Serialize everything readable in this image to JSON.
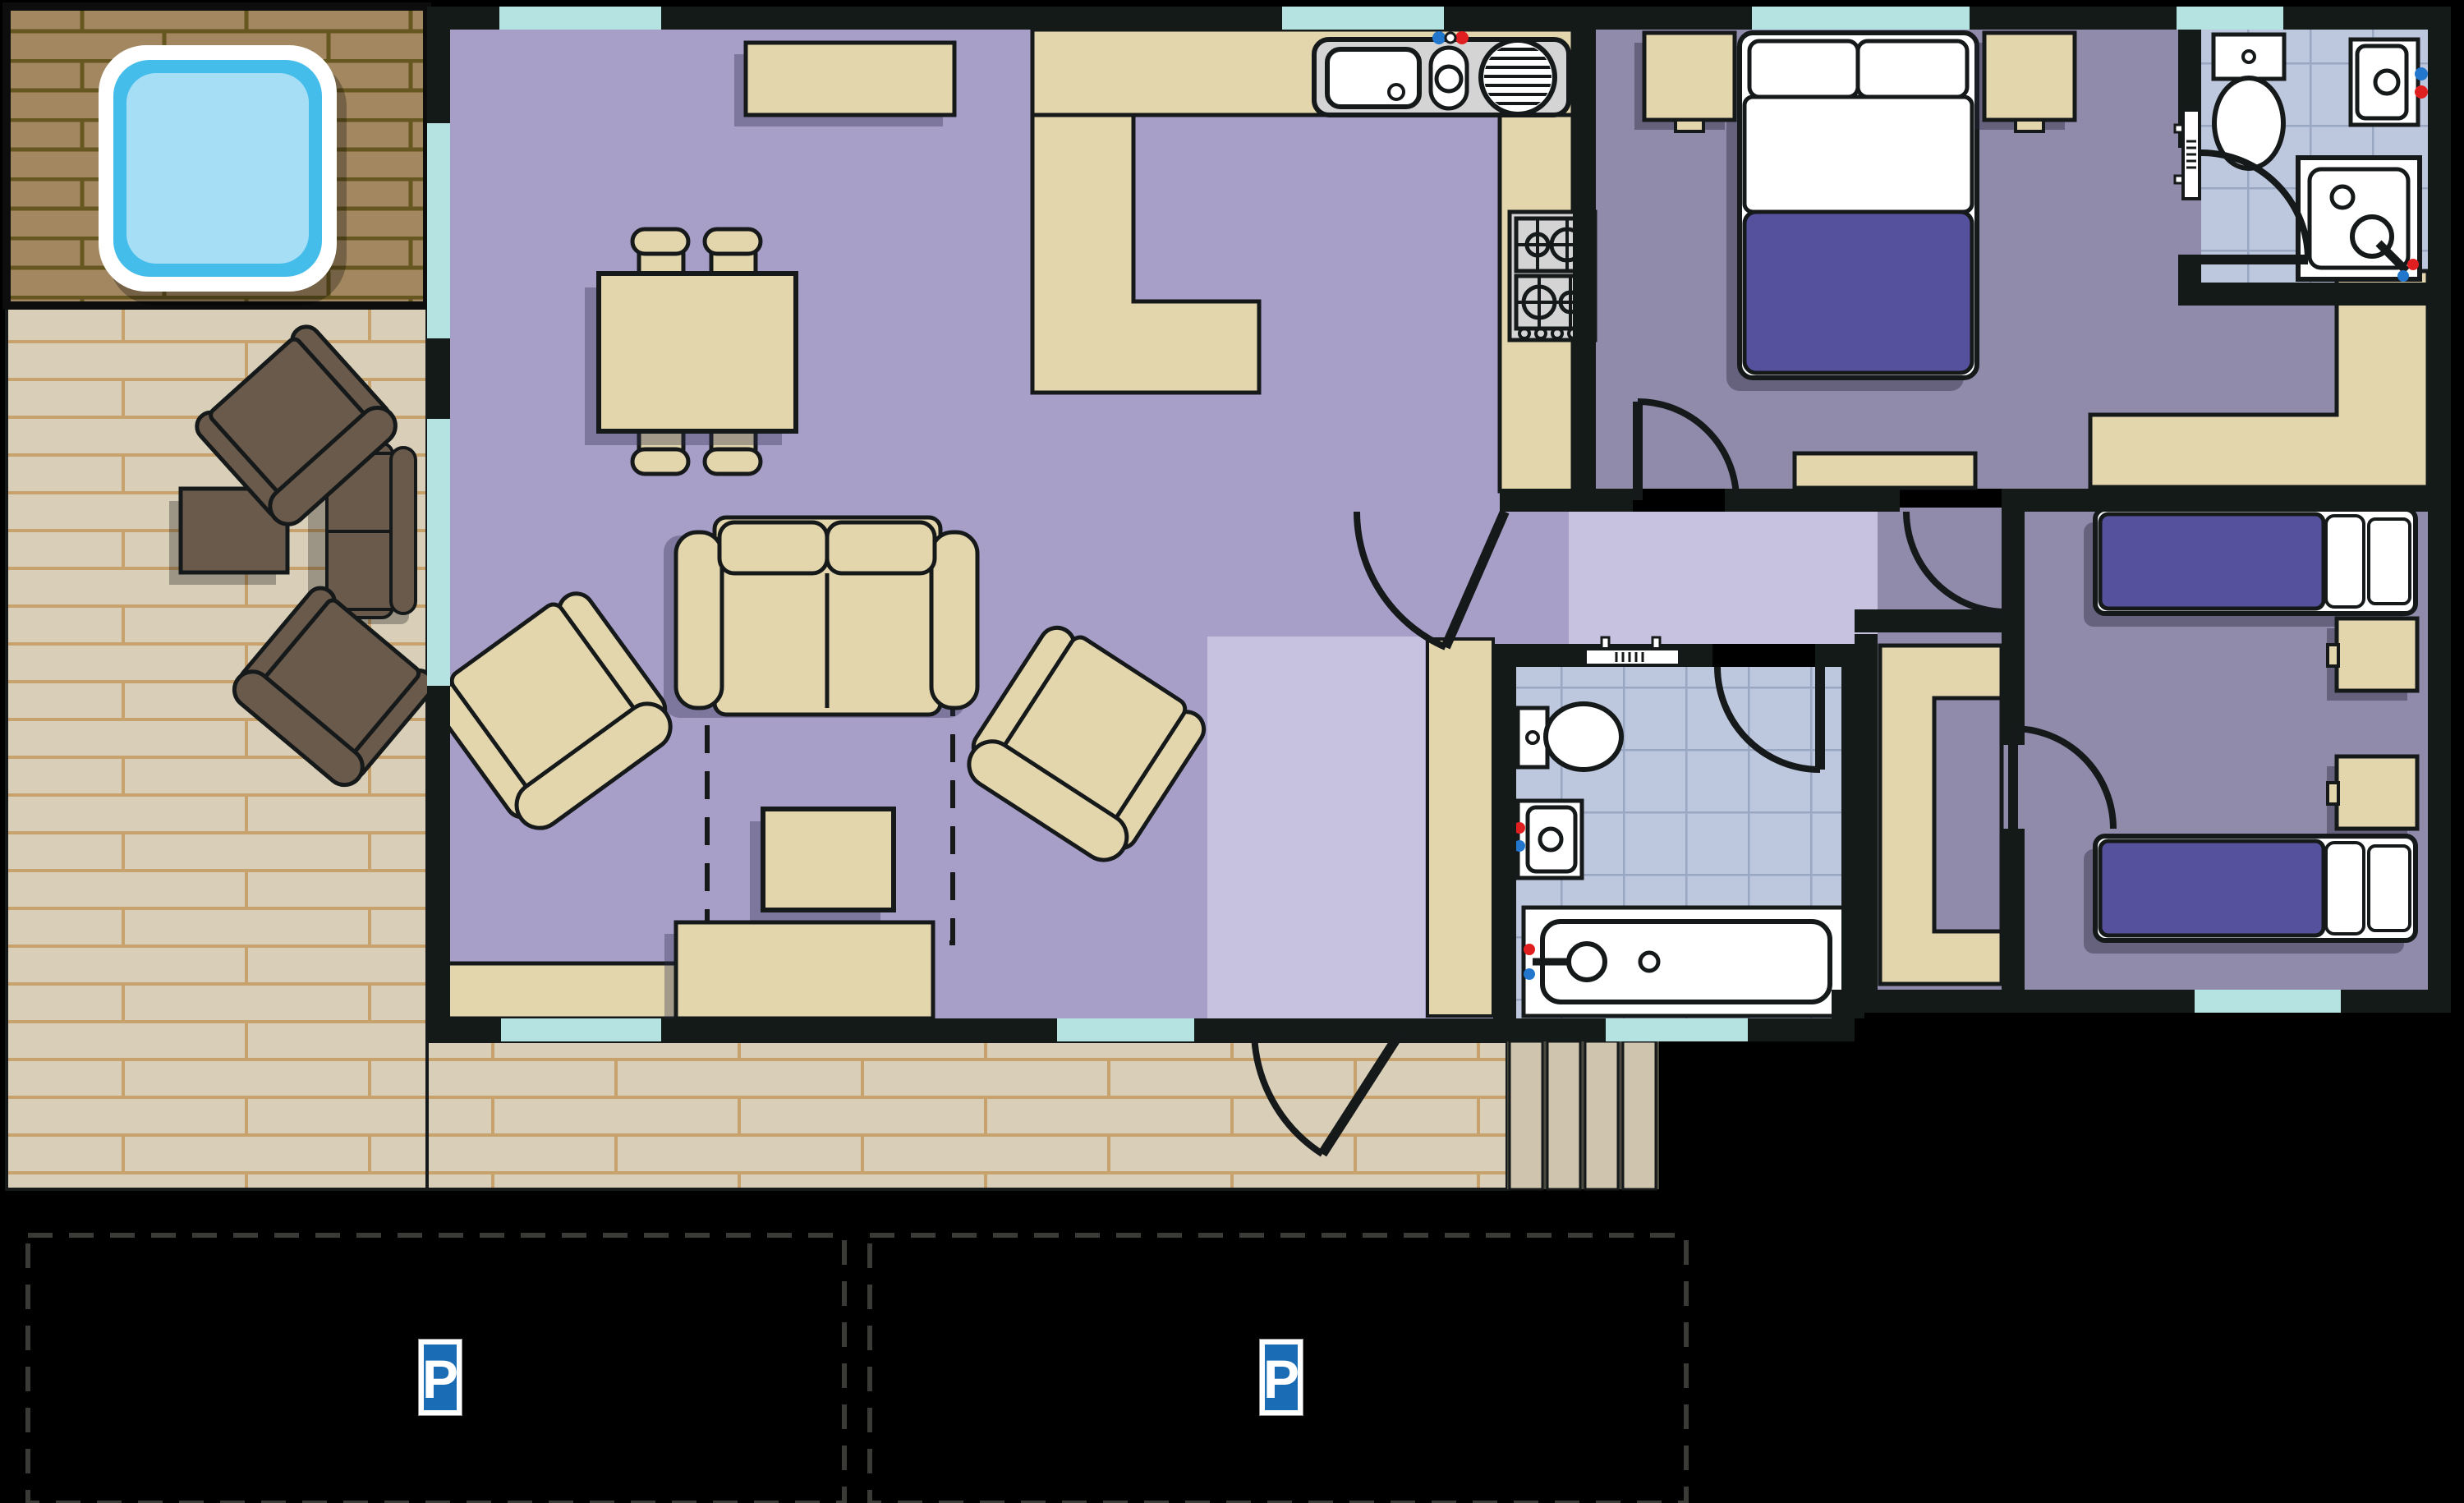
{
  "plan": {
    "type": "holiday-lodge-floor-plan",
    "rooms": [
      "hot-tub-patio",
      "deck",
      "living-room",
      "kitchen",
      "entrance-hall",
      "hallway",
      "bathroom",
      "master-bedroom",
      "ensuite-bathroom",
      "twin-bedroom",
      "parking"
    ]
  },
  "palette": {
    "outside": "#000000",
    "wall": "#141a18",
    "floor_living": "#a89fc9",
    "floor_bedroom": "#908aab",
    "floor_hall": "#c7c2df",
    "floor_tile": "#bdc7dd",
    "tile_line": "#9aa7c2",
    "window": "#b4e3e1",
    "cream": "#e3d6ac",
    "duvet": "#55519c",
    "deck_brick": "#d9cfb9",
    "deck_line": "#c8a26d",
    "patio_brick": "#a28760",
    "patio_line": "#66561f",
    "brown_furniture": "#6a5a4b",
    "hot_tub_ring": "#45bdea",
    "hot_tub_water": "#a6def6",
    "fixture_gray": "#d4d4d4",
    "parking_sign_blue": "#1a6cb5",
    "tap_hot": "#e02020",
    "tap_cold": "#2277cc"
  },
  "parking": {
    "bays": [
      {
        "sign_label": "P"
      },
      {
        "sign_label": "P"
      }
    ]
  }
}
